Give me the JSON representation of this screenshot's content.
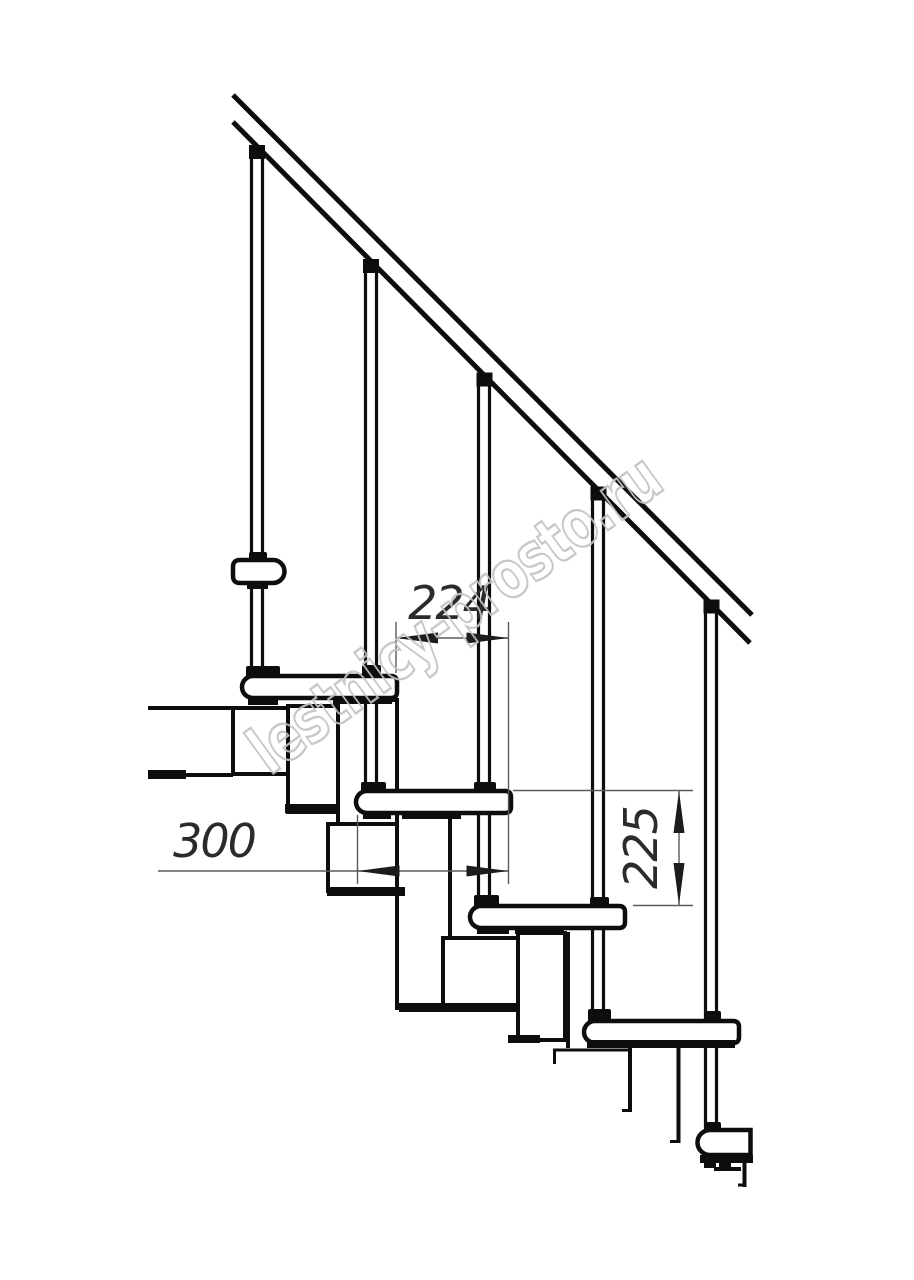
{
  "drawing": {
    "kind": "staircase-side-elevation-technical-drawing",
    "dimensions": {
      "run_between_steps": "224",
      "tread_depth": "300",
      "step_rise": "225"
    },
    "watermark": "lestnicy-prosto.ru",
    "colors": {
      "background": "#ffffff",
      "line": "#0d0d0d",
      "thin_line": "#5a5a5a",
      "arrow": "#1c1c1c",
      "dim_text": "#2b2b2b",
      "watermark_stroke": "#c3c3c3"
    }
  }
}
